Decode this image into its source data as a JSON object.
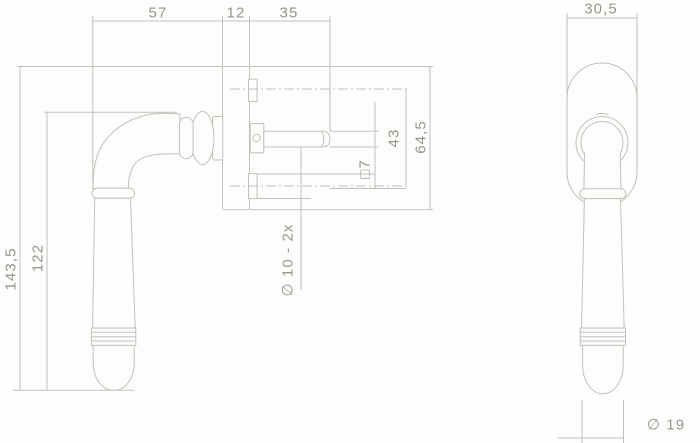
{
  "colors": {
    "background": "#fdfdfc",
    "line": "#c3c0bb",
    "text": "#98948e"
  },
  "side_view": {
    "dims": {
      "d57": "57",
      "d12": "12",
      "d35": "35",
      "d143_5": "143,5",
      "d122": "122",
      "d43": "43",
      "d64_5": "64,5",
      "square7": "□7",
      "holes": "∅ 10 - 2x"
    }
  },
  "front_view": {
    "dims": {
      "d30_5": "30,5",
      "d19": "∅ 19"
    }
  }
}
